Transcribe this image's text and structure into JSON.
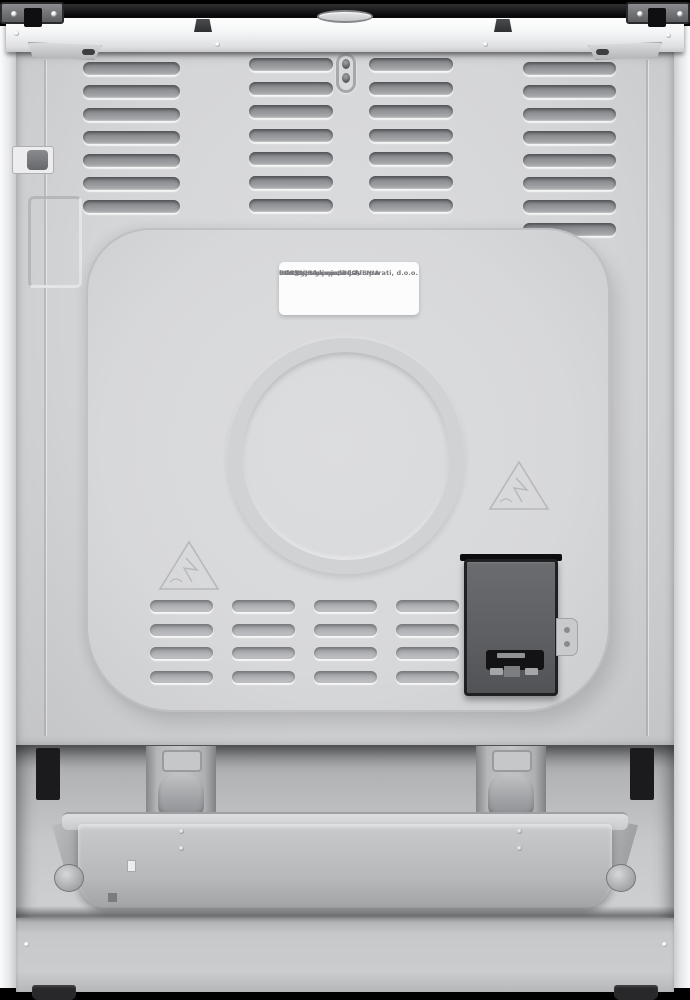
{
  "scene": {
    "type": "product-photo",
    "subject": "Freestanding cooker, rear view",
    "background_color": "#000000"
  },
  "manufacturer_label": {
    "lines": [
      "GORENJE gospodinjski aparati, d.o.o.",
      "Partizanska cesta 12,",
      "SI-3320 Velenje, SLOVENIA",
      "info@gorenje.com"
    ]
  },
  "colors": {
    "chassis_white": "#f2f3f4",
    "rear_panel_gray": "#d4d5d7",
    "louver_shadow_gray": "#8f9194",
    "terminal_box_gray": "#5d5e62",
    "cooktop_trim_black": "#141416",
    "label_background": "#fcfcfd"
  }
}
